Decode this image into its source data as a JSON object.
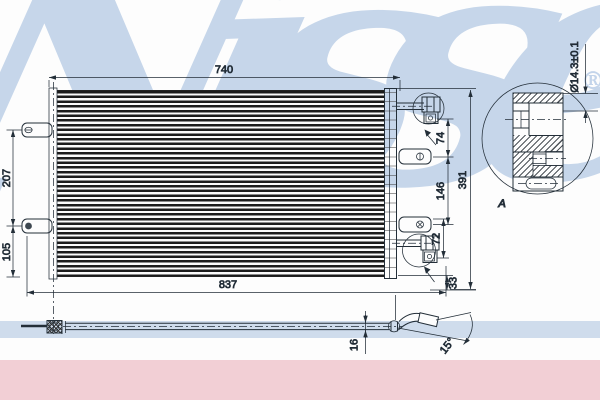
{
  "watermark": {
    "text": "Nissens",
    "registered": "®"
  },
  "detail_view": {
    "label": "A",
    "bore_diameter": "Ø14.3±0.1"
  },
  "dimensions": {
    "core_width_top": "740",
    "overall_width_bottom": "837",
    "overall_height_right": "391",
    "left_upper_span": "207",
    "left_lower_span": "105",
    "right_port_to_bracket": "74",
    "right_bracket_spacing": "146",
    "right_bracket_to_port": "72",
    "right_bottom_offset": "33",
    "pipe_outer_height": "16",
    "pipe_bend_angle": "15°"
  },
  "colors": {
    "line": "#232e38",
    "watermark": "#bdd0e7",
    "band_blue": "#cfdcec",
    "band_pink": "#f2cfd5"
  }
}
